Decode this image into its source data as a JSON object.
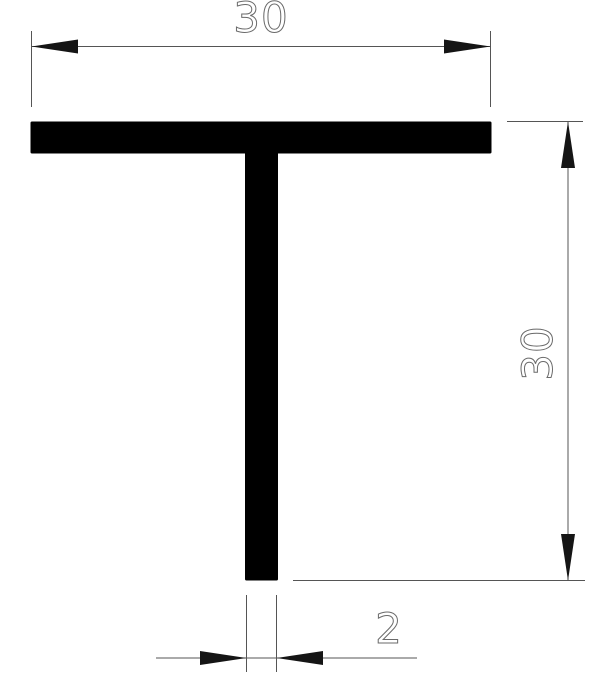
{
  "drawing": {
    "type": "technical-cross-section",
    "profile_shape": "T-profile",
    "background_color": "#ffffff",
    "profile_color": "#000000",
    "line_color": "#555555",
    "arrow_color": "#151515",
    "text_color": "#6a6a6a",
    "dimensions": {
      "flange_width": {
        "label": "30",
        "orientation": "horizontal",
        "position": "top"
      },
      "overall_height": {
        "label": "30",
        "orientation": "vertical",
        "position": "right"
      },
      "web_thickness": {
        "label": "2",
        "orientation": "horizontal",
        "position": "bottom"
      }
    }
  }
}
